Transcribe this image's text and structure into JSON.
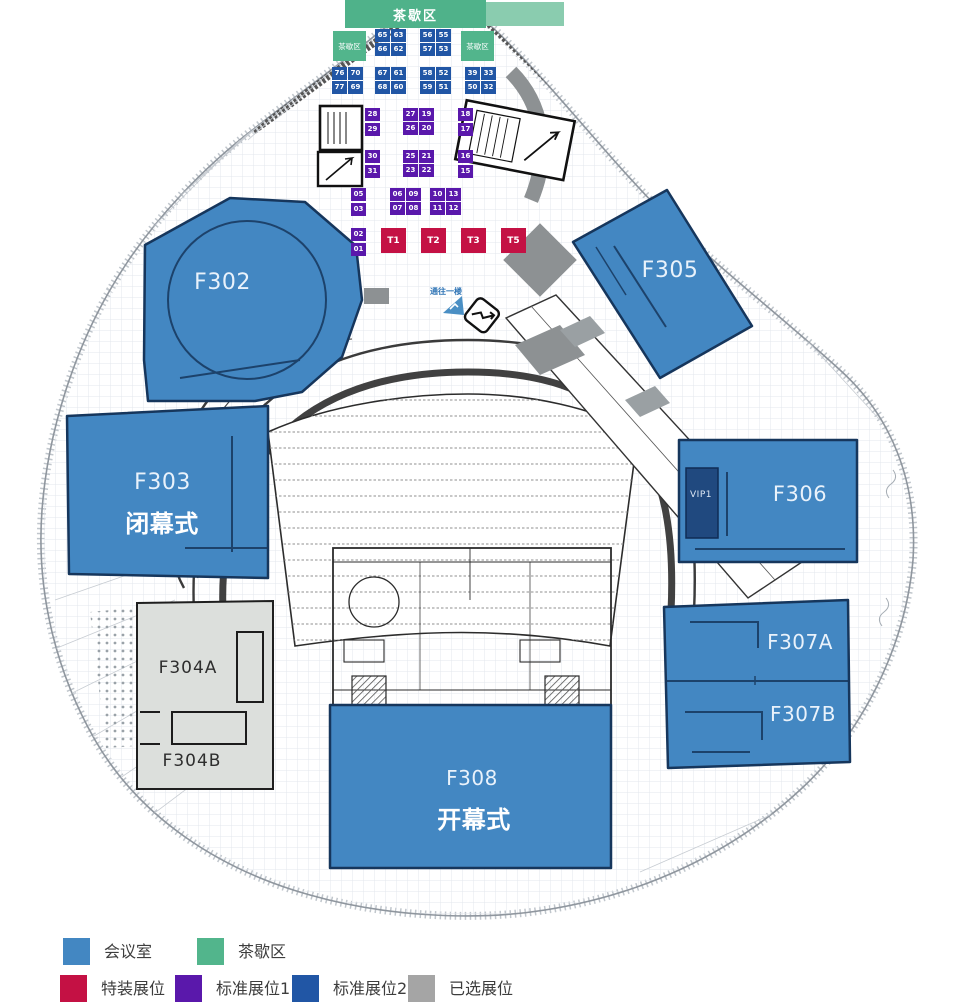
{
  "palette": {
    "room_blue": "#4387c2",
    "room_border": "#16365c",
    "vip_navy": "#20497f",
    "standard_booth_1": "#5a18ab",
    "standard_booth_2": "#2156a5",
    "special_booth_red": "#c41144",
    "tea_green": "#52b58c",
    "gray_zone": "#8d9193",
    "f304_gray": "#dcdfdc"
  },
  "tea": {
    "banner": "茶歇区",
    "left_square": "茶歇区",
    "right_square": "茶歇区"
  },
  "booth_groups": [
    {
      "cols": 2,
      "cells": [
        "65",
        "63",
        "66",
        "62"
      ]
    },
    {
      "cols": 2,
      "cells": [
        "56",
        "55",
        "57",
        "53"
      ]
    },
    {
      "cols": 2,
      "cells": [
        "76",
        "70",
        "77",
        "69"
      ]
    },
    {
      "cols": 2,
      "cells": [
        "67",
        "61",
        "68",
        "60"
      ]
    },
    {
      "cols": 2,
      "cells": [
        "58",
        "52",
        "59",
        "51"
      ]
    },
    {
      "cols": 2,
      "cells": [
        "39",
        "33",
        "50",
        "32"
      ]
    },
    {
      "cols": 1,
      "cells": [
        "28",
        "29"
      ]
    },
    {
      "cols": 2,
      "cells": [
        "27",
        "19",
        "26",
        "20"
      ]
    },
    {
      "cols": 1,
      "cells": [
        "18",
        "17"
      ]
    },
    {
      "cols": 1,
      "cells": [
        "30",
        "31"
      ]
    },
    {
      "cols": 2,
      "cells": [
        "25",
        "21",
        "23",
        "22"
      ]
    },
    {
      "cols": 1,
      "cells": [
        "16",
        "15"
      ]
    },
    {
      "cols": 1,
      "cells": [
        "05",
        "03"
      ]
    },
    {
      "cols": 2,
      "cells": [
        "06",
        "09",
        "07",
        "08"
      ]
    },
    {
      "cols": 2,
      "cells": [
        "10",
        "13",
        "11",
        "12"
      ]
    },
    {
      "cols": 1,
      "cells": [
        "02",
        "01"
      ]
    }
  ],
  "t_booths": [
    "T1",
    "T2",
    "T3",
    "T5"
  ],
  "rooms": {
    "f302": {
      "label": "F302"
    },
    "f303": {
      "label": "F303",
      "subtitle": "闭幕式"
    },
    "f304a": {
      "label": "F304A"
    },
    "f304b": {
      "label": "F304B"
    },
    "f305": {
      "label": "F305"
    },
    "f306": {
      "label": "F306"
    },
    "vip1": {
      "label": "VIP1"
    },
    "f307a": {
      "label": "F307A"
    },
    "f307b": {
      "label": "F307B"
    },
    "f308": {
      "label": "F308",
      "subtitle": "开幕式"
    }
  },
  "annotations": {
    "to_first_floor": "通往一楼"
  },
  "legend": {
    "row1": [
      {
        "label": "会议室",
        "color": "#4387c2"
      },
      {
        "label": "茶歇区",
        "color": "#52b58c"
      }
    ],
    "row2": [
      {
        "label": "特装展位",
        "color": "#c41144"
      },
      {
        "label": "标准展位1",
        "color": "#5a18ab"
      },
      {
        "label": "标准展位2",
        "color": "#2156a5"
      },
      {
        "label": "已选展位",
        "color": "#a5a5a5"
      }
    ]
  }
}
